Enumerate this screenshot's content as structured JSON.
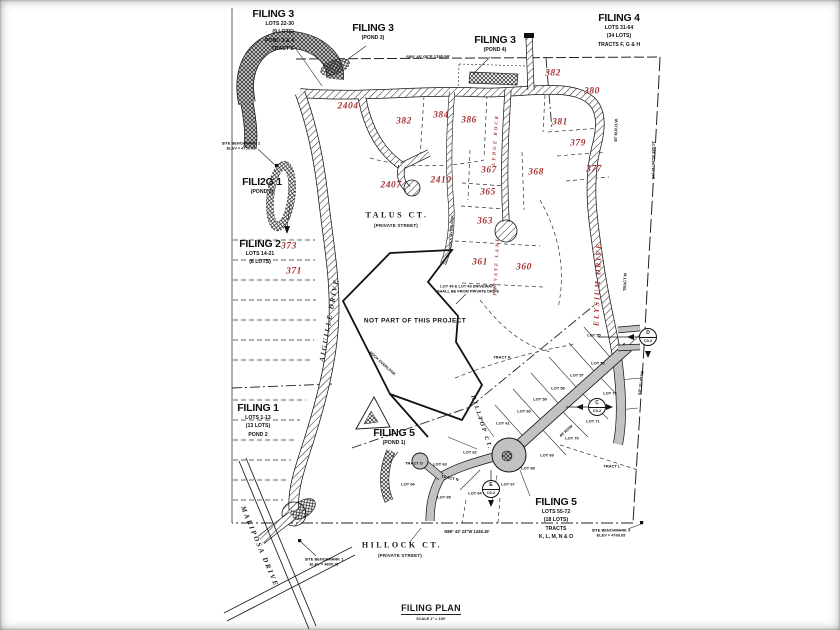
{
  "colors": {
    "red": "#a93535",
    "black": "#1a1a1a",
    "road_gray": "#c2c2c2"
  },
  "title_block": {
    "title": "FILING PLAN",
    "scale": "SCALE 1\" = 100'"
  },
  "filing_blocks": [
    {
      "title": "FILING 3",
      "lines": [
        "LOTS 22-30",
        "(9 LOTS)",
        "POND 3 & 4",
        "TRACT E"
      ],
      "x": 218,
      "y": 8,
      "w": 76,
      "align": "right"
    },
    {
      "title": "FILING 3",
      "lines": [
        "(POND 3)"
      ],
      "x": 342,
      "y": 22,
      "w": 62,
      "align": "center"
    },
    {
      "title": "FILING 3",
      "lines": [
        "(POND 4)"
      ],
      "x": 464,
      "y": 34,
      "w": 62,
      "align": "center"
    },
    {
      "title": "FILING 4",
      "lines": [
        "LOTS 31-64",
        "(34 LOTS)",
        "TRACTS F, G & H"
      ],
      "x": 575,
      "y": 12,
      "w": 88,
      "align": "center"
    },
    {
      "title": "FILI2G 1",
      "lines": [
        "(POND 2)"
      ],
      "x": 222,
      "y": 176,
      "w": 80,
      "align": "center"
    },
    {
      "title": "FILING 2",
      "lines": [
        "LOTS 14-21",
        "(8 LOTS)"
      ],
      "x": 222,
      "y": 238,
      "w": 76,
      "align": "center"
    },
    {
      "title": "FILING 1",
      "lines": [
        "LOTS 1-13",
        "(13 LOTS)",
        "POND 2"
      ],
      "x": 222,
      "y": 402,
      "w": 72,
      "align": "center"
    },
    {
      "title": "FILING 5",
      "lines": [
        "(POND 1)"
      ],
      "x": 362,
      "y": 427,
      "w": 64,
      "align": "center"
    },
    {
      "title": "FILING 5",
      "lines": [
        "LOTS 55-72",
        "(18 LOTS)",
        "TRACTS",
        "K, L, M, N & O"
      ],
      "x": 514,
      "y": 496,
      "w": 84,
      "align": "center"
    }
  ],
  "text_labels": [
    {
      "n": "red-number",
      "cls": "rn",
      "t": "2404",
      "x": 348,
      "y": 107,
      "fs": 9.5,
      "c": "red"
    },
    {
      "n": "red-number",
      "cls": "rn",
      "t": "382",
      "x": 404,
      "y": 122,
      "fs": 9.5,
      "c": "red"
    },
    {
      "n": "red-number",
      "cls": "rn",
      "t": "384",
      "x": 441,
      "y": 116,
      "fs": 9.5,
      "c": "red"
    },
    {
      "n": "red-number",
      "cls": "rn",
      "t": "386",
      "x": 469,
      "y": 121,
      "fs": 9.5,
      "c": "red"
    },
    {
      "n": "red-number",
      "cls": "rn",
      "t": "382",
      "x": 553,
      "y": 74,
      "fs": 9.5,
      "c": "red"
    },
    {
      "n": "red-number",
      "cls": "rn",
      "t": "380",
      "x": 592,
      "y": 92,
      "fs": 9.5,
      "c": "red"
    },
    {
      "n": "red-number",
      "cls": "rn",
      "t": "381",
      "x": 560,
      "y": 123,
      "fs": 9.5,
      "c": "red"
    },
    {
      "n": "red-number",
      "cls": "rn",
      "t": "379",
      "x": 578,
      "y": 144,
      "fs": 9.5,
      "c": "red"
    },
    {
      "n": "red-number",
      "cls": "rn",
      "t": "377",
      "x": 594,
      "y": 170,
      "fs": 9.5,
      "c": "red"
    },
    {
      "n": "red-number",
      "cls": "rn",
      "t": "2407",
      "x": 391,
      "y": 186,
      "fs": 9.5,
      "c": "red"
    },
    {
      "n": "red-number",
      "cls": "rn",
      "t": "2410",
      "x": 441,
      "y": 181,
      "fs": 9.5,
      "c": "red"
    },
    {
      "n": "red-number",
      "cls": "rn",
      "t": "367",
      "x": 489,
      "y": 171,
      "fs": 9.5,
      "c": "red"
    },
    {
      "n": "red-number",
      "cls": "rn",
      "t": "368",
      "x": 536,
      "y": 173,
      "fs": 9.5,
      "c": "red"
    },
    {
      "n": "red-number",
      "cls": "rn",
      "t": "365",
      "x": 488,
      "y": 193,
      "fs": 9.5,
      "c": "red"
    },
    {
      "n": "red-number",
      "cls": "rn",
      "t": "363",
      "x": 485,
      "y": 222,
      "fs": 9.5,
      "c": "red"
    },
    {
      "n": "red-number",
      "cls": "rn",
      "t": "361",
      "x": 480,
      "y": 263,
      "fs": 9.5,
      "c": "red"
    },
    {
      "n": "red-number",
      "cls": "rn",
      "t": "360",
      "x": 524,
      "y": 268,
      "fs": 9.5,
      "c": "red"
    },
    {
      "n": "red-number",
      "cls": "rn",
      "t": "373",
      "x": 289,
      "y": 247,
      "fs": 9.5,
      "c": "red"
    },
    {
      "n": "red-number",
      "cls": "rn",
      "t": "371",
      "x": 294,
      "y": 272,
      "fs": 9.5,
      "c": "red"
    },
    {
      "n": "street-name",
      "cls": "rs",
      "t": "ELYSIUM DRIVE",
      "x": 598,
      "y": 284,
      "fs": 7.5,
      "rot": -88,
      "c": "red"
    },
    {
      "n": "street-name",
      "cls": "rs",
      "t": "PRIVATE LANE",
      "x": 498,
      "y": 266,
      "fs": 5,
      "rot": -87,
      "c": "red"
    },
    {
      "n": "street-name",
      "cls": "rs",
      "t": "LEDGE ROCK",
      "x": 497,
      "y": 140,
      "fs": 5,
      "rot": -86,
      "c": "red"
    },
    {
      "n": "street-name",
      "cls": "st",
      "t": "TALUS CT.",
      "x": 397,
      "y": 216,
      "fs": 8
    },
    {
      "n": "street-subtitle",
      "cls": "sub",
      "t": "(PRIVATE STREET)",
      "x": 396,
      "y": 226,
      "fs": 4.5
    },
    {
      "n": "street-name",
      "cls": "st",
      "t": "HILLOCK CT.",
      "x": 402,
      "y": 546,
      "fs": 8
    },
    {
      "n": "street-subtitle",
      "cls": "sub",
      "t": "(PRIVATE STREET)",
      "x": 400,
      "y": 556,
      "fs": 4.5
    },
    {
      "n": "street-name",
      "cls": "sti",
      "t": "AIGUILLE DRIVE",
      "x": 330,
      "y": 320,
      "fs": 7,
      "rot": -80
    },
    {
      "n": "street-name",
      "cls": "sti",
      "t": "MARIPOSA DRIVE",
      "x": 259,
      "y": 547,
      "fs": 7,
      "rot": 67
    },
    {
      "n": "street-name",
      "cls": "sti",
      "t": "HILLTOP CT.",
      "x": 481,
      "y": 423,
      "fs": 6,
      "rot": 72
    },
    {
      "n": "street-name",
      "cls": "lt",
      "t": "ROCK OVERLOOK",
      "x": 452,
      "y": 232,
      "fs": 3.8,
      "rot": -86
    },
    {
      "n": "street-name",
      "cls": "lt",
      "t": "ROCK OVERLOOK",
      "x": 382,
      "y": 364,
      "fs": 3.8,
      "rot": 42
    },
    {
      "n": "lot-label",
      "cls": "lt",
      "t": "TRACT K",
      "x": 502,
      "y": 357
    },
    {
      "n": "lot-label",
      "cls": "lt",
      "t": "LOT 55",
      "x": 594,
      "y": 335
    },
    {
      "n": "lot-label",
      "cls": "lt",
      "t": "LOT 56",
      "x": 598,
      "y": 363
    },
    {
      "n": "lot-label",
      "cls": "lt",
      "t": "LOT 57",
      "x": 577,
      "y": 375
    },
    {
      "n": "lot-label",
      "cls": "lt",
      "t": "LOT 58",
      "x": 558,
      "y": 388
    },
    {
      "n": "lot-label",
      "cls": "lt",
      "t": "LOT 59",
      "x": 540,
      "y": 399
    },
    {
      "n": "lot-label",
      "cls": "lt",
      "t": "LOT 60",
      "x": 524,
      "y": 411
    },
    {
      "n": "lot-label",
      "cls": "lt",
      "t": "LOT 61",
      "x": 503,
      "y": 423
    },
    {
      "n": "lot-label",
      "cls": "lt",
      "t": "LOT 62",
      "x": 470,
      "y": 452
    },
    {
      "n": "lot-label",
      "cls": "lt",
      "t": "LOT 63",
      "x": 440,
      "y": 464
    },
    {
      "n": "lot-label",
      "cls": "lt",
      "t": "LOT 64",
      "x": 475,
      "y": 493
    },
    {
      "n": "lot-label",
      "cls": "lt",
      "t": "LOT 65",
      "x": 444,
      "y": 497
    },
    {
      "n": "lot-label",
      "cls": "lt",
      "t": "LOT 66",
      "x": 408,
      "y": 484
    },
    {
      "n": "lot-label",
      "cls": "lt",
      "t": "LOT 67",
      "x": 508,
      "y": 484
    },
    {
      "n": "lot-label",
      "cls": "lt",
      "t": "LOT 68",
      "x": 528,
      "y": 468
    },
    {
      "n": "lot-label",
      "cls": "lt",
      "t": "LOT 69",
      "x": 547,
      "y": 455
    },
    {
      "n": "lot-label",
      "cls": "lt",
      "t": "LOT 70",
      "x": 572,
      "y": 438
    },
    {
      "n": "lot-label",
      "cls": "lt",
      "t": "LOT 71",
      "x": 593,
      "y": 421
    },
    {
      "n": "lot-label",
      "cls": "lt",
      "t": "LOT 72",
      "x": 610,
      "y": 393
    },
    {
      "n": "lot-label",
      "cls": "lt",
      "t": "TRACT O",
      "x": 414,
      "y": 463
    },
    {
      "n": "lot-label",
      "cls": "lt",
      "t": "TRACT L",
      "x": 612,
      "y": 466
    },
    {
      "n": "lot-label",
      "cls": "lt",
      "t": "TRACT M",
      "x": 625,
      "y": 282,
      "rot": -88
    },
    {
      "n": "lot-label",
      "cls": "lt",
      "t": "TRACT N",
      "x": 450,
      "y": 478,
      "rot": 12
    },
    {
      "n": "lot-label",
      "cls": "lt",
      "t": "44' ROW",
      "x": 566,
      "y": 431,
      "rot": -42
    },
    {
      "n": "note",
      "cls": "nt npp",
      "t": "NOT PART OF THIS PROJECT",
      "x": 415,
      "y": 322,
      "fs": 6.5
    },
    {
      "n": "note",
      "cls": "nt",
      "t": "LOT 49 & LOT 48 DRIVEWAYS\nSHALL BE FROM PRIVATE DRIVE",
      "x": 468,
      "y": 289
    },
    {
      "n": "note",
      "cls": "nt",
      "t": "SITE BENCHMARK 2\nELEV = 4750.63",
      "x": 241,
      "y": 146
    },
    {
      "n": "note",
      "cls": "nt",
      "t": "SITE BENCHMARK 1\nELEV = 4800.15",
      "x": 324,
      "y": 562
    },
    {
      "n": "note",
      "cls": "nt",
      "t": "SITE BENCHMARK 3\nELEV = 4769.05",
      "x": 611,
      "y": 533
    },
    {
      "n": "bearing",
      "cls": "nt",
      "t": "S89° 45' 08\"E  1380.99'",
      "x": 428,
      "y": 57,
      "fs": 4.2,
      "rot": -0.5
    },
    {
      "n": "bearing",
      "cls": "nt",
      "t": "N89° 43' 23\"W  1348.19'",
      "x": 467,
      "y": 532,
      "fs": 4.2
    },
    {
      "n": "bearing",
      "cls": "nt",
      "t": "S0° 31' 06\"W  335.13'",
      "x": 653,
      "y": 160,
      "fs": 4,
      "rot": -90
    },
    {
      "n": "bearing",
      "cls": "nt",
      "t": "S0° 31' 06\"W",
      "x": 641,
      "y": 383,
      "fs": 4,
      "rot": -83
    },
    {
      "n": "bearing",
      "cls": "nt",
      "t": "40' M.R.O.W.",
      "x": 616,
      "y": 130,
      "fs": 4,
      "rot": -88
    }
  ],
  "markers": [
    {
      "letter": "D",
      "sheet": "C0.2",
      "x": 648,
      "y": 337
    },
    {
      "letter": "C",
      "sheet": "C0.2",
      "x": 597,
      "y": 407
    },
    {
      "letter": "E",
      "sheet": "C0.2",
      "x": 491,
      "y": 489
    }
  ]
}
